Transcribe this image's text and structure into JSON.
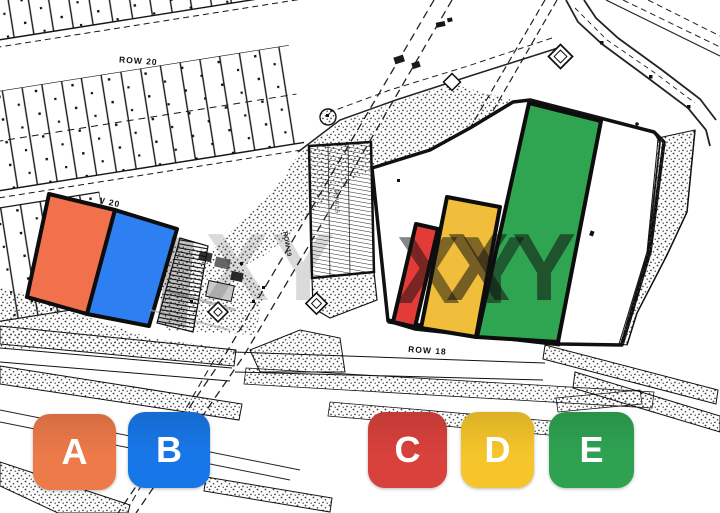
{
  "watermark": {
    "text": "XY"
  },
  "map_labels": {
    "row20_top": "ROW 20",
    "row20_mid": "ROW 20",
    "row19": "ROW 19",
    "row18": "ROW 18"
  },
  "plots": [
    {
      "id": "A",
      "color": "#F0714B",
      "points": "49,194 115,210 87,314 27,297"
    },
    {
      "id": "B",
      "color": "#2E80F2",
      "points": "115,210 177,229 149,326 87,314"
    },
    {
      "id": "C",
      "color": "#E33B38",
      "points": "416,224 438,229 415,327 393,322"
    },
    {
      "id": "D",
      "color": "#F0BE3B",
      "points": "447,197 500,207 476,337 421,328"
    },
    {
      "id": "E",
      "color": "#2FA552",
      "points": "529,103 601,121 558,342 477,337"
    }
  ],
  "buttons": [
    {
      "label": "A",
      "color": "#ED7A49"
    },
    {
      "label": "B",
      "color": "#1877E8"
    },
    {
      "label": "C",
      "color": "#D8413C"
    },
    {
      "label": "D",
      "color": "#F5C52B"
    },
    {
      "label": "E",
      "color": "#2EA251"
    }
  ]
}
